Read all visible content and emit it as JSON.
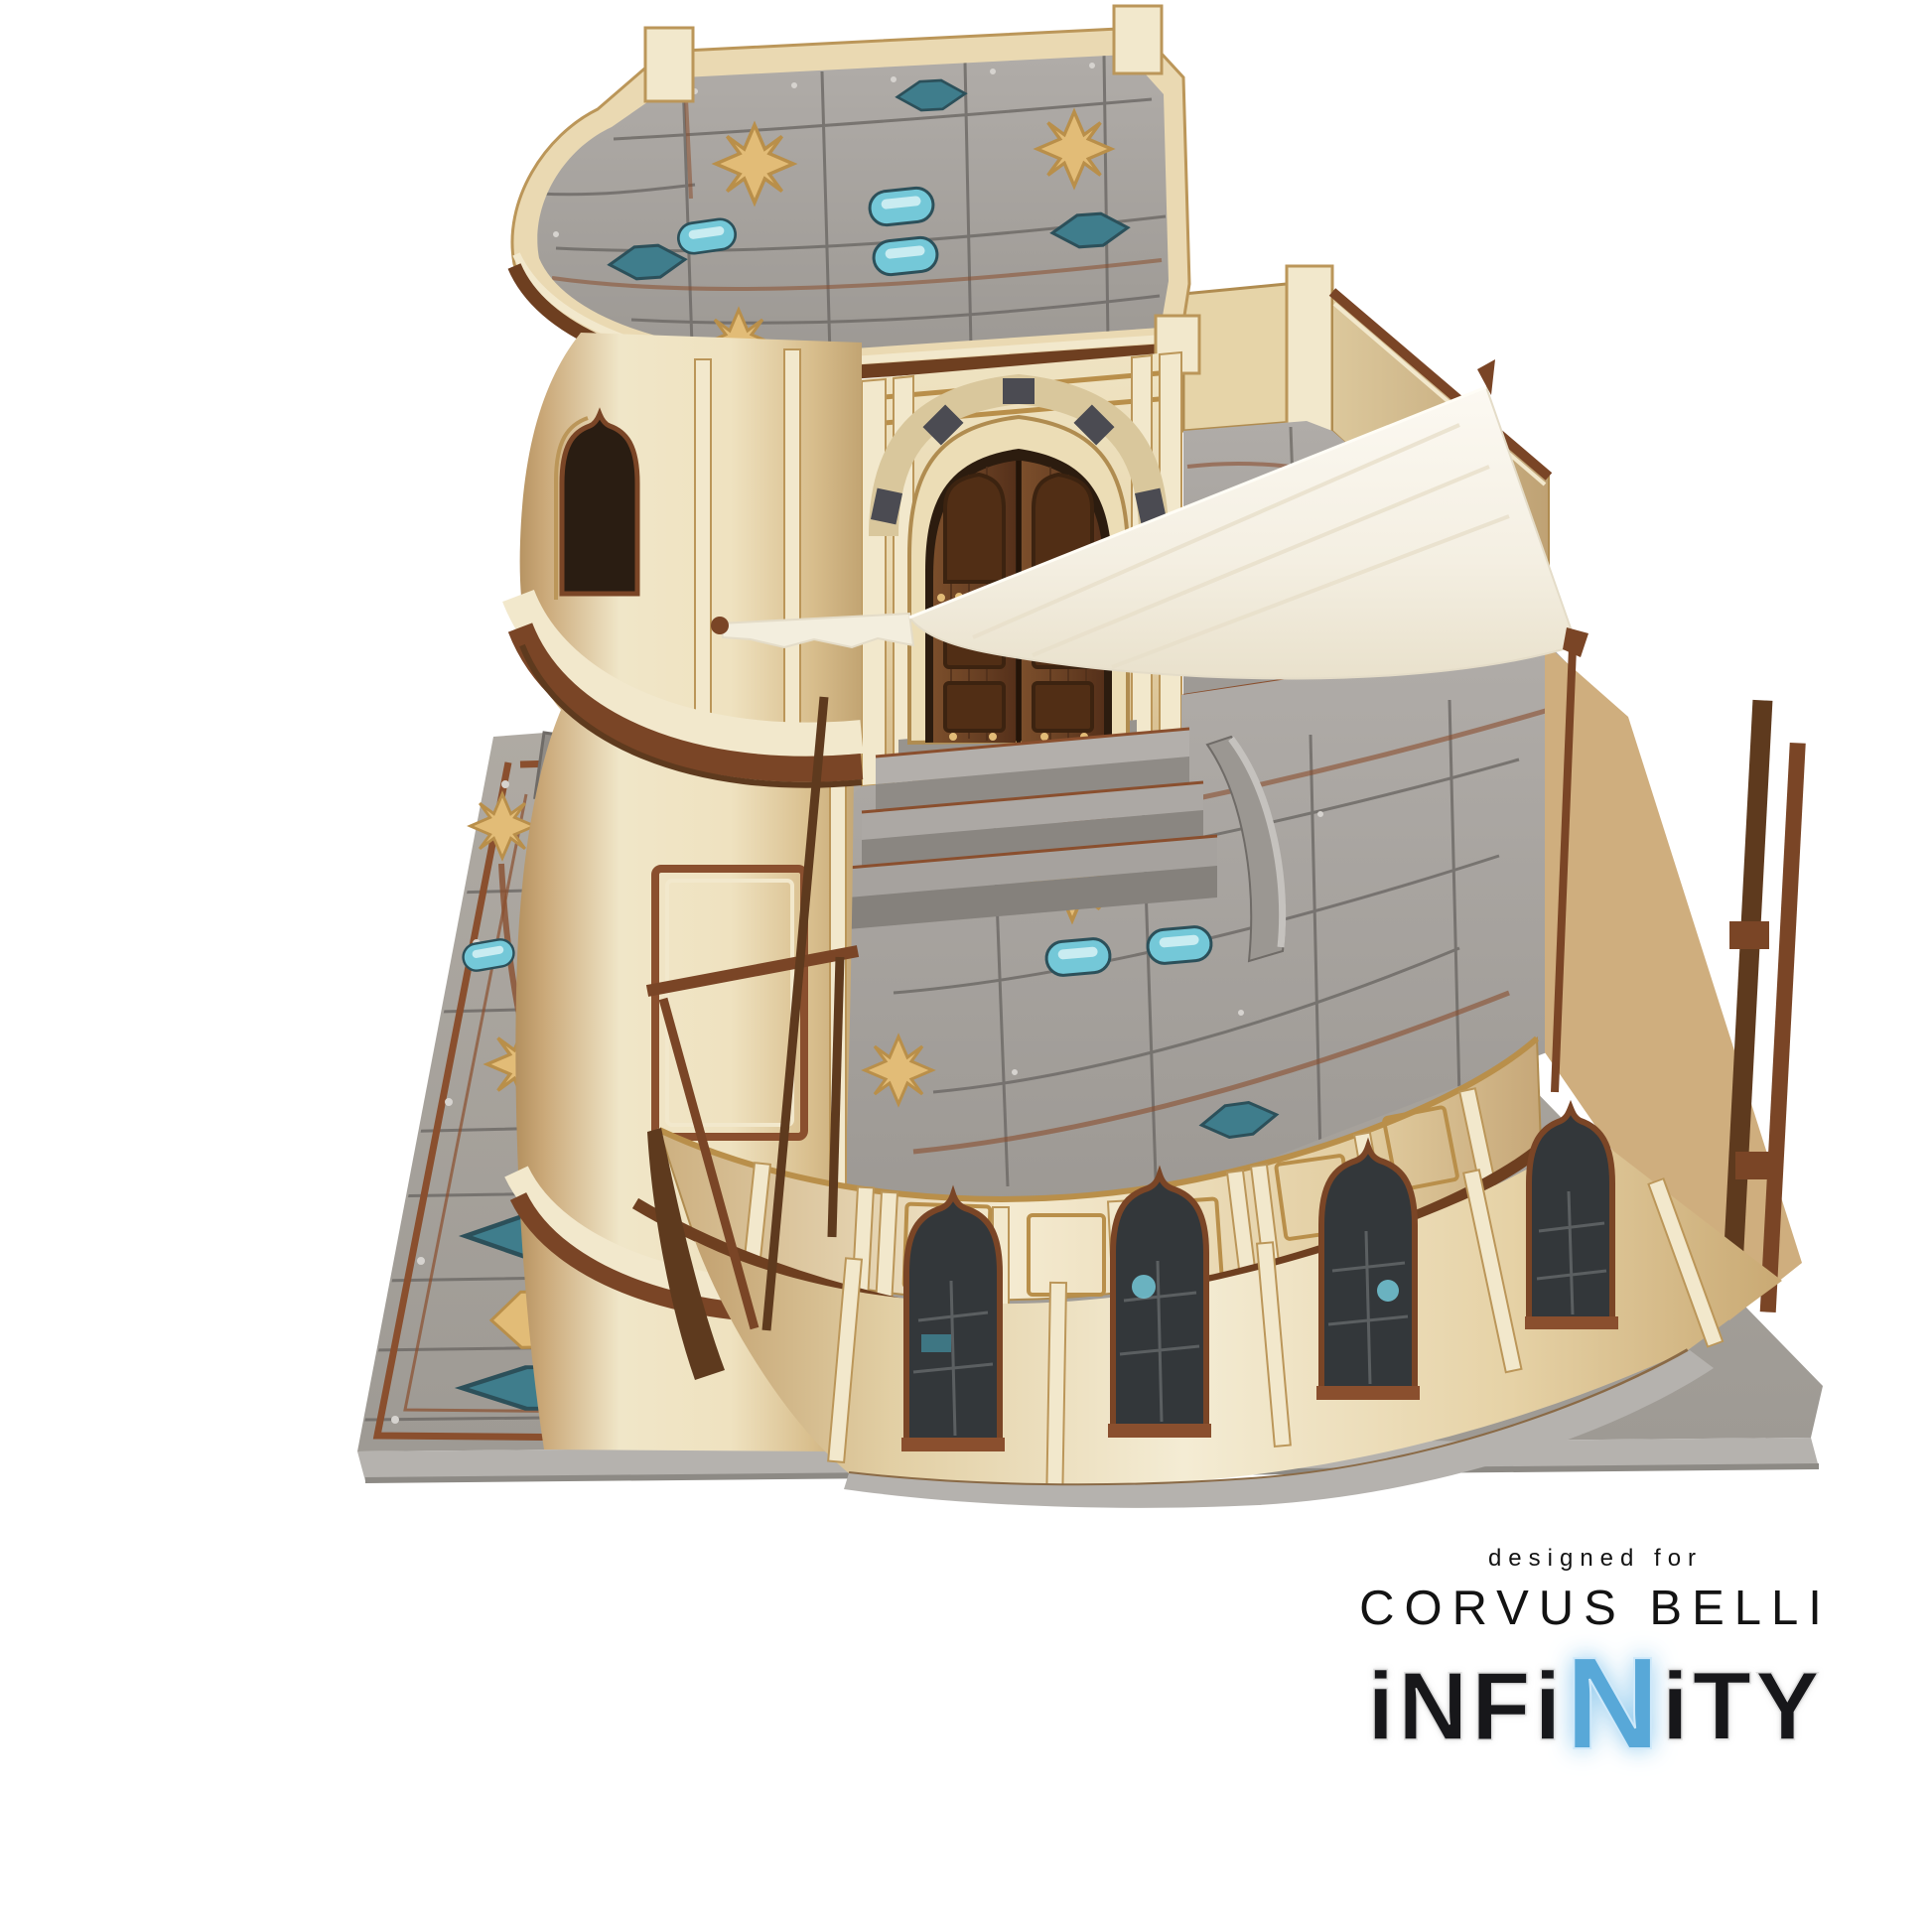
{
  "scene": {
    "type": "product-photo",
    "background": "#ffffff",
    "subject": "Tabletop wargame terrain building model: cream two-story desert house with round tower, gray sci-fi tiled roofs and ground plate, arched wooden double door, curved bay with ogee windows, white cloth awning on wooden poles"
  },
  "branding": {
    "tagline": "designed for",
    "company": "CORVUS BELLI",
    "product": "INFINITY",
    "logo": {
      "pre": "iNFi",
      "accent": "N",
      "post": "iTY"
    }
  },
  "colors": {
    "bg": "#ffffff",
    "cream_light": "#f2e8cc",
    "cream": "#e6d4a8",
    "cream_dark": "#cfae7e",
    "tan": "#bb9659",
    "trim": "#b08c50",
    "brown": "#7a4526",
    "brown_dark": "#5e3a1e",
    "rust": "#8a4f2e",
    "wood": "#6a4124",
    "wood_dark": "#4a2a12",
    "roof_light": "#b3afab",
    "roof": "#a5a19c",
    "roof_dark": "#8f8b86",
    "grout": "#6f6b67",
    "slate": "#4b4b52",
    "gold": "#e2bc77",
    "gold_light": "#f3ddb0",
    "gold_dark": "#b98f4a",
    "teal": "#74c8d8",
    "teal_dark": "#3f7d8c",
    "teal_deep": "#2c505a",
    "base_gray": "#a6a29c",
    "base_edge": "#b5b2ae",
    "interior_dark": "#2a1d12",
    "window_dark": "#33373a",
    "cloth": "#f7f3e8",
    "cloth_shadow": "#e4dcc8",
    "ink": "#131313",
    "logo_blue": "#58a8d8",
    "logo_blue_light": "#cfe9fa"
  }
}
